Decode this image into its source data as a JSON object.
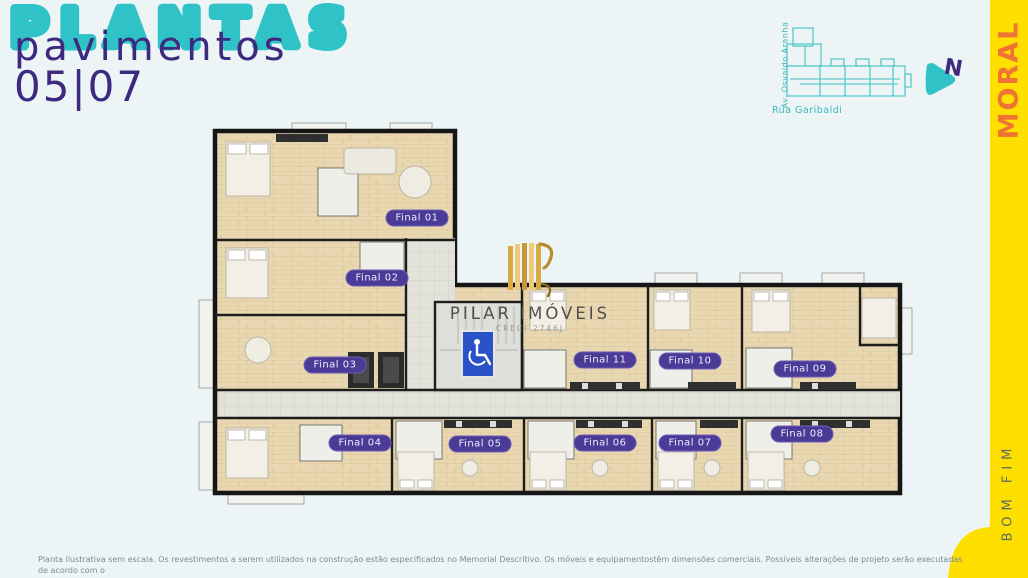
{
  "header": {
    "title": "PLANTAS",
    "subtitle": "pavimentos",
    "floors": "05|07"
  },
  "locator": {
    "street_left": "Av. Osvaldo Aranha",
    "street_bottom": "Rua Garibaldi",
    "north_label": "N"
  },
  "brand": {
    "side_top": "MORAL",
    "side_bottom": "BOM FIM"
  },
  "logo": {
    "name": "PILAR IMÓVEIS",
    "creci": "CRECI 2746J"
  },
  "plan": {
    "units": [
      "Final 01",
      "Final 02",
      "Final 03",
      "Final 04",
      "Final 05",
      "Final 06",
      "Final 07",
      "Final 08",
      "Final 09",
      "Final 10",
      "Final 11"
    ]
  },
  "footer": {
    "line1": "Planta ilustrativa sem escala. Os revestimentos a serem utilizados na construção estão especificados no Memorial Descritivo. Os móveis e equipamentostêm dimensões comerciais. Possíveis alterações de projeto serão executadas de acordo com o",
    "line2": "memorial descritivo do empreendimento."
  },
  "colors": {
    "teal": "#2fc3c8",
    "purple": "#3d2a80",
    "yellow": "#ffdf00",
    "orange": "#ef7434",
    "badge_purple": "#4b3b97",
    "accessibility_blue": "#2a52c8",
    "gold": "#d9a946",
    "background": "#edf4f6"
  }
}
